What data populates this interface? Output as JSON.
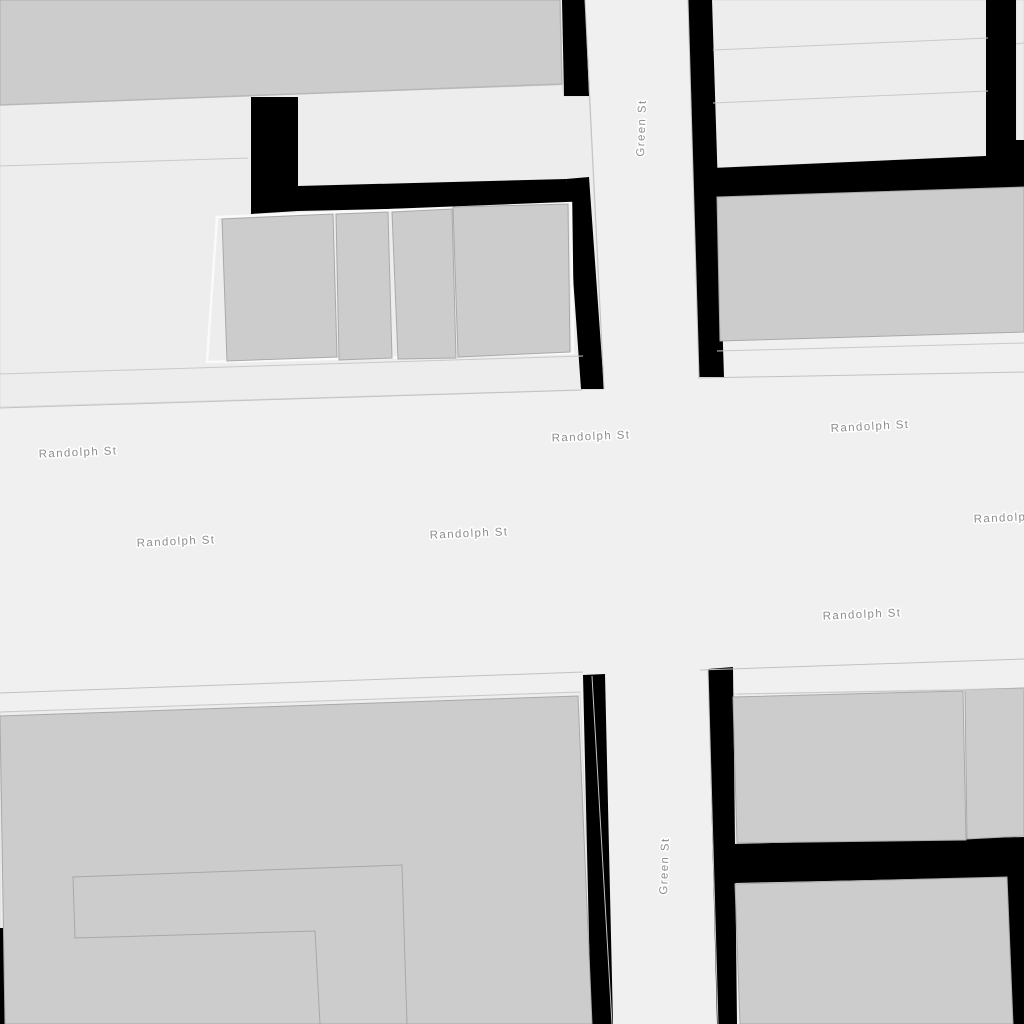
{
  "map": {
    "type": "street-map",
    "labels": {
      "randolph_st": "Randolph St",
      "green_st": "Green St"
    },
    "streets": [
      {
        "name": "Randolph St",
        "orientation": "horizontal"
      },
      {
        "name": "Green St",
        "orientation": "vertical"
      }
    ],
    "colors": {
      "road": "#f0f0f0",
      "parcel": "#ededed",
      "building": "#cccccc",
      "building_outline": "#a9a9a9",
      "gap_black": "#000000",
      "boundary_line": "#c9c9c9",
      "parcel_outline_light": "#fafafa",
      "label_text": "#8d8d8d",
      "label_halo": "#ffffff"
    }
  }
}
